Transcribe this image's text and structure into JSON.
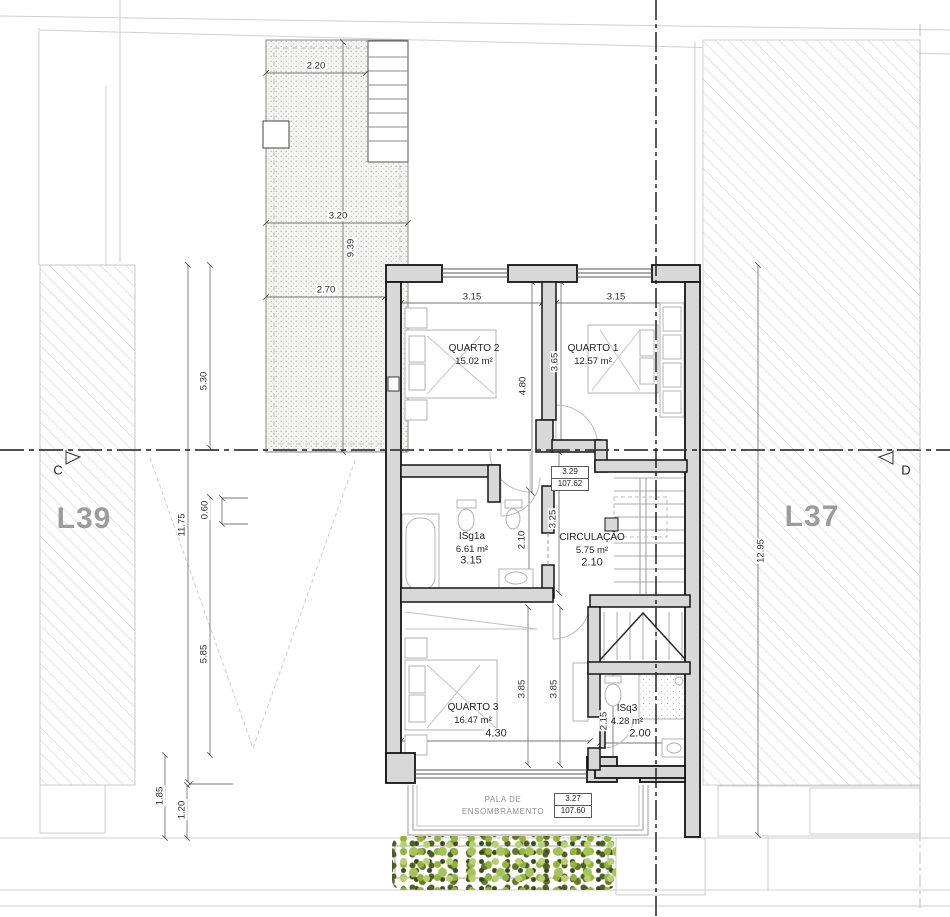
{
  "plan": {
    "lot_left": "L39",
    "lot_right": "L37",
    "section_left": "C",
    "section_right": "D",
    "rooms": {
      "quarto2": {
        "name": "QUARTO 2",
        "area": "15.02 m²"
      },
      "quarto1": {
        "name": "QUARTO 1",
        "area": "12.57 m²"
      },
      "isg1a": {
        "name": "ISg1a",
        "area": "6.61 m²",
        "width": "3.15"
      },
      "circulacao": {
        "name": "CIRCULAÇÃO",
        "area": "5.75 m²",
        "width": "2.10"
      },
      "quarto3": {
        "name": "QUARTO 3",
        "area": "16.47 m²",
        "width": "4.30"
      },
      "isq3": {
        "name": "ISq3",
        "area": "4.28 m²",
        "width": "2.00"
      }
    },
    "pala": {
      "line1": "PALA DE",
      "line2": "ENSOMBRAMENTO"
    },
    "levels": {
      "upper": {
        "value": "3.29",
        "altitude": "107.62"
      },
      "lower": {
        "value": "3.27",
        "altitude": "107.60"
      }
    },
    "dims": {
      "terrace_w1": "2.20",
      "terrace_w2": "3.20",
      "terrace_h": "9.39",
      "terrace_w3": "2.70",
      "left_a": "5.30",
      "left_total": "11.75",
      "left_b": "0.60",
      "left_c": "5.85",
      "left_d": "1.85",
      "left_e": "1.20",
      "right_total": "12.95",
      "q2_w": "3.15",
      "q1_w": "3.15",
      "q2_h": "4.80",
      "q1_h": "3.65",
      "hall_h": "3.25",
      "bath_h": "2.10",
      "q3_h1": "3.85",
      "q3_h2": "3.85",
      "isq3_h": "2.15"
    }
  },
  "colors": {
    "wall_fill": "#d8d8d8",
    "wall_line": "#141414",
    "hatch_line": "#c9c9c9",
    "hedge_light": "#b9cf72",
    "hedge_dark": "#39491a",
    "lot_label_gray": "#9c9c9c"
  }
}
